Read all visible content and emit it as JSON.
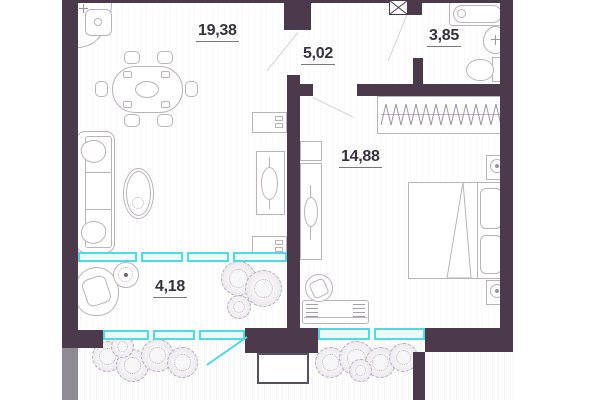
{
  "plan": {
    "rooms": [
      {
        "name": "living-room",
        "area_label": "19,38"
      },
      {
        "name": "hallway",
        "area_label": "5,02"
      },
      {
        "name": "bathroom",
        "area_label": "3,85"
      },
      {
        "name": "bedroom",
        "area_label": "14,88"
      },
      {
        "name": "balcony",
        "area_label": "4,18"
      }
    ],
    "colors": {
      "wall": "#4b3a4c",
      "wall_gray": "#8f8b94",
      "window": "#58d7de",
      "window_fill": "#eafbfc",
      "furniture_line": "#b9b3bc",
      "label": "#38323f"
    }
  }
}
